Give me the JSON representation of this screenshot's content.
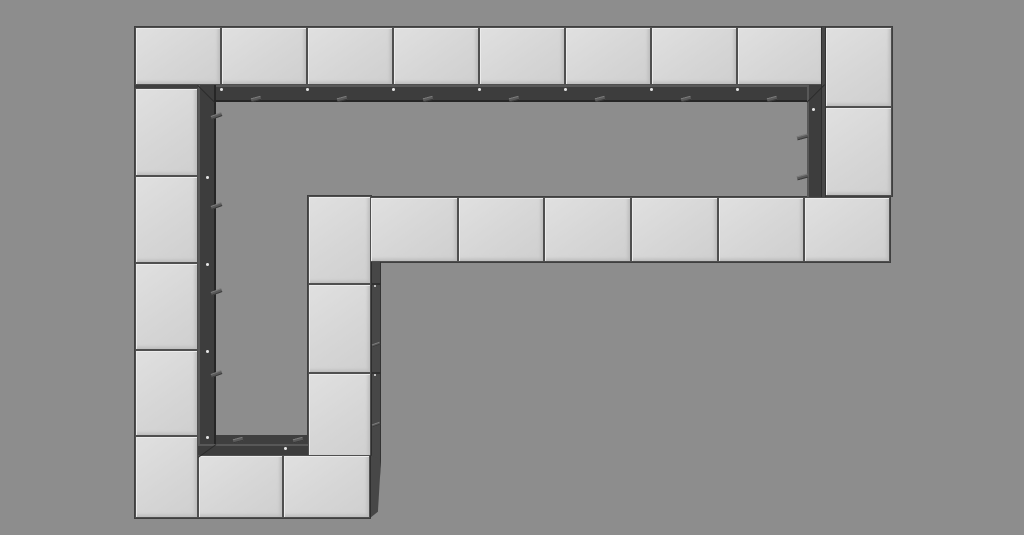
{
  "scene": {
    "description": "3d-viewport-render-of-modular-cube-ring-with-inner-frame-channel",
    "canvas": {
      "width": 1024,
      "height": 535
    },
    "colors": {
      "background": "#8d8d8d",
      "cube_face": "#d6d6d6",
      "cube_edge": "#4f4f4f",
      "frame": "#3d3d3d",
      "frame_highlight": "#585858",
      "side_face": "#474747",
      "screw_dot": "#e6e6e6"
    },
    "unders": [
      {
        "id": "backing-top-row",
        "x": 134,
        "y": 26,
        "w": 759,
        "h": 61
      },
      {
        "id": "backing-right-col",
        "x": 824,
        "y": 26,
        "w": 69,
        "h": 171
      },
      {
        "id": "backing-mid-row",
        "x": 369,
        "y": 196,
        "w": 522,
        "h": 67
      },
      {
        "id": "backing-mid-col",
        "x": 307,
        "y": 195,
        "w": 65,
        "h": 266
      },
      {
        "id": "backing-left-col",
        "x": 134,
        "y": 85,
        "w": 65,
        "h": 434
      },
      {
        "id": "backing-bottom-row",
        "x": 197,
        "y": 435,
        "w": 174,
        "h": 84
      }
    ],
    "frame_bars": [
      {
        "id": "frame-bar-top",
        "x": 198,
        "y": 85,
        "w": 627,
        "h": 17,
        "dir": "h"
      },
      {
        "id": "frame-bar-left",
        "x": 198,
        "y": 85,
        "w": 18,
        "h": 359,
        "dir": "v"
      },
      {
        "id": "frame-bar-bottom",
        "x": 198,
        "y": 444,
        "w": 111,
        "h": 13,
        "dir": "h"
      },
      {
        "id": "frame-bar-right",
        "x": 807,
        "y": 85,
        "w": 18,
        "h": 112,
        "dir": "v"
      }
    ],
    "cubes": [
      {
        "id": "cube-top-1",
        "x": 135,
        "y": 27,
        "w": 86,
        "h": 58
      },
      {
        "id": "cube-top-2",
        "x": 221,
        "y": 27,
        "w": 86,
        "h": 58
      },
      {
        "id": "cube-top-3",
        "x": 307,
        "y": 27,
        "w": 86,
        "h": 58
      },
      {
        "id": "cube-top-4",
        "x": 393,
        "y": 27,
        "w": 86,
        "h": 58
      },
      {
        "id": "cube-top-5",
        "x": 479,
        "y": 27,
        "w": 86,
        "h": 58
      },
      {
        "id": "cube-top-6",
        "x": 565,
        "y": 27,
        "w": 86,
        "h": 58
      },
      {
        "id": "cube-top-7",
        "x": 651,
        "y": 27,
        "w": 86,
        "h": 58
      },
      {
        "id": "cube-top-8",
        "x": 737,
        "y": 27,
        "w": 88,
        "h": 58
      },
      {
        "id": "cube-right-1",
        "x": 825,
        "y": 27,
        "w": 67,
        "h": 80
      },
      {
        "id": "cube-right-2",
        "x": 825,
        "y": 107,
        "w": 67,
        "h": 89
      },
      {
        "id": "cube-mid-row-1",
        "x": 370,
        "y": 197,
        "w": 88,
        "h": 65
      },
      {
        "id": "cube-mid-row-2",
        "x": 458,
        "y": 197,
        "w": 86,
        "h": 65
      },
      {
        "id": "cube-mid-row-3",
        "x": 544,
        "y": 197,
        "w": 87,
        "h": 65
      },
      {
        "id": "cube-mid-row-4",
        "x": 631,
        "y": 197,
        "w": 87,
        "h": 65
      },
      {
        "id": "cube-mid-row-5",
        "x": 718,
        "y": 197,
        "w": 86,
        "h": 65
      },
      {
        "id": "cube-mid-row-6",
        "x": 804,
        "y": 197,
        "w": 86,
        "h": 65
      },
      {
        "id": "cube-mid-col-1",
        "x": 308,
        "y": 196,
        "w": 63,
        "h": 88
      },
      {
        "id": "cube-mid-col-2",
        "x": 308,
        "y": 284,
        "w": 63,
        "h": 89
      },
      {
        "id": "cube-mid-col-3",
        "x": 308,
        "y": 373,
        "w": 63,
        "h": 87
      },
      {
        "id": "cube-left-1",
        "x": 135,
        "y": 88,
        "w": 63,
        "h": 88
      },
      {
        "id": "cube-left-2",
        "x": 135,
        "y": 176,
        "w": 63,
        "h": 87
      },
      {
        "id": "cube-left-3",
        "x": 135,
        "y": 263,
        "w": 63,
        "h": 87
      },
      {
        "id": "cube-left-4",
        "x": 135,
        "y": 350,
        "w": 63,
        "h": 86
      },
      {
        "id": "cube-left-5",
        "x": 135,
        "y": 436,
        "w": 63,
        "h": 82
      },
      {
        "id": "cube-bottom-1",
        "x": 198,
        "y": 455,
        "w": 85,
        "h": 63
      },
      {
        "id": "cube-bottom-2",
        "x": 283,
        "y": 455,
        "w": 87,
        "h": 63
      }
    ],
    "side_faces": [
      {
        "id": "side-mid-col-right",
        "x": 371,
        "y": 262,
        "w": 10,
        "h": 198,
        "clip": ""
      },
      {
        "id": "side-bottom-row-right",
        "x": 370,
        "y": 455,
        "w": 11,
        "h": 63,
        "clip": "polygon(0 0, 100% 8%, 72% 90%, 0 100%)"
      },
      {
        "id": "side-right-col-left",
        "x": 821,
        "y": 27,
        "w": 5,
        "h": 170,
        "clip": ""
      }
    ],
    "seams": [
      {
        "id": "seam-mid-col-a",
        "x": 371,
        "y": 283,
        "w": 10,
        "h": 2
      },
      {
        "id": "seam-mid-col-b",
        "x": 371,
        "y": 372,
        "w": 10,
        "h": 2
      }
    ],
    "tabs": [
      {
        "id": "bracket-tab",
        "x": 251,
        "y": 97,
        "w": 10,
        "h": 4,
        "rot": -15
      },
      {
        "id": "bracket-tab",
        "x": 337,
        "y": 97,
        "w": 10,
        "h": 4,
        "rot": -15
      },
      {
        "id": "bracket-tab",
        "x": 423,
        "y": 97,
        "w": 10,
        "h": 4,
        "rot": -15
      },
      {
        "id": "bracket-tab",
        "x": 509,
        "y": 97,
        "w": 10,
        "h": 4,
        "rot": -15
      },
      {
        "id": "bracket-tab",
        "x": 595,
        "y": 97,
        "w": 10,
        "h": 4,
        "rot": -15
      },
      {
        "id": "bracket-tab",
        "x": 681,
        "y": 97,
        "w": 10,
        "h": 4,
        "rot": -15
      },
      {
        "id": "bracket-tab",
        "x": 767,
        "y": 97,
        "w": 10,
        "h": 4,
        "rot": -15
      },
      {
        "id": "bracket-tab",
        "x": 211,
        "y": 114,
        "w": 11,
        "h": 4,
        "rot": -20
      },
      {
        "id": "bracket-tab",
        "x": 211,
        "y": 204,
        "w": 11,
        "h": 4,
        "rot": -20
      },
      {
        "id": "bracket-tab",
        "x": 211,
        "y": 290,
        "w": 11,
        "h": 4,
        "rot": -20
      },
      {
        "id": "bracket-tab",
        "x": 211,
        "y": 372,
        "w": 11,
        "h": 4,
        "rot": -20
      },
      {
        "id": "bracket-tab",
        "x": 797,
        "y": 135,
        "w": 11,
        "h": 4,
        "rot": -15
      },
      {
        "id": "bracket-tab",
        "x": 797,
        "y": 175,
        "w": 11,
        "h": 4,
        "rot": -15
      },
      {
        "id": "bracket-tab",
        "x": 233,
        "y": 438,
        "w": 10,
        "h": 4,
        "rot": -15
      },
      {
        "id": "bracket-tab",
        "x": 293,
        "y": 438,
        "w": 10,
        "h": 4,
        "rot": -15
      },
      {
        "id": "bracket-tab",
        "x": 372,
        "y": 343,
        "w": 8,
        "h": 3,
        "rot": -20
      },
      {
        "id": "bracket-tab",
        "x": 372,
        "y": 423,
        "w": 8,
        "h": 3,
        "rot": -20
      }
    ],
    "dots": [
      {
        "id": "screw-dot",
        "x": 220,
        "y": 88,
        "s": 3
      },
      {
        "id": "screw-dot",
        "x": 306,
        "y": 88,
        "s": 3
      },
      {
        "id": "screw-dot",
        "x": 392,
        "y": 88,
        "s": 3
      },
      {
        "id": "screw-dot",
        "x": 478,
        "y": 88,
        "s": 3
      },
      {
        "id": "screw-dot",
        "x": 564,
        "y": 88,
        "s": 3
      },
      {
        "id": "screw-dot",
        "x": 650,
        "y": 88,
        "s": 3
      },
      {
        "id": "screw-dot",
        "x": 736,
        "y": 88,
        "s": 3
      },
      {
        "id": "screw-dot",
        "x": 206,
        "y": 176,
        "s": 3
      },
      {
        "id": "screw-dot",
        "x": 206,
        "y": 263,
        "s": 3
      },
      {
        "id": "screw-dot",
        "x": 206,
        "y": 350,
        "s": 3
      },
      {
        "id": "screw-dot",
        "x": 206,
        "y": 436,
        "s": 3
      },
      {
        "id": "screw-dot",
        "x": 812,
        "y": 108,
        "s": 3
      },
      {
        "id": "screw-dot",
        "x": 284,
        "y": 447,
        "s": 3
      },
      {
        "id": "screw-dot",
        "x": 374,
        "y": 285,
        "s": 2
      },
      {
        "id": "screw-dot",
        "x": 374,
        "y": 374,
        "s": 2
      }
    ],
    "miters": [
      {
        "id": "frame-miter-top-left",
        "x": 198,
        "y": 85,
        "len": 25,
        "rot": 45
      },
      {
        "id": "frame-miter-top-right",
        "x": 825,
        "y": 85,
        "len": 25,
        "rot": 135
      },
      {
        "id": "frame-miter-bottom-left",
        "x": 198,
        "y": 457,
        "len": 22,
        "rot": -36
      }
    ]
  }
}
